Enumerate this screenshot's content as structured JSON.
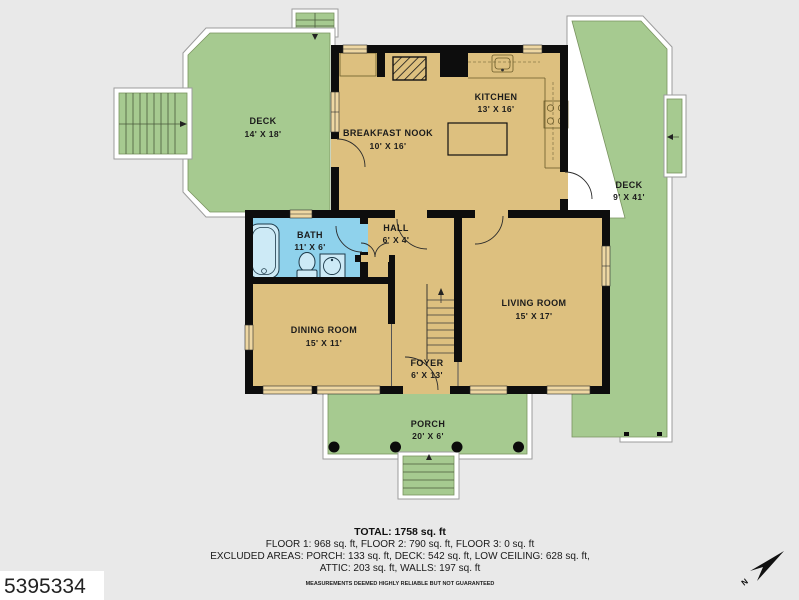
{
  "colors": {
    "background": "#e9e9e9",
    "floor": "#ddc07f",
    "deck": "#a6ca90",
    "bath": "#8fd2ec",
    "wall": "#0d0d0d",
    "window": "#eed7a3"
  },
  "rooms": [
    {
      "id": "deck-left",
      "name": "DECK",
      "dims": "14' X 18'"
    },
    {
      "id": "breakfast-nook",
      "name": "BREAKFAST NOOK",
      "dims": "10' X 16'"
    },
    {
      "id": "kitchen",
      "name": "KITCHEN",
      "dims": "13' X 16'"
    },
    {
      "id": "deck-right",
      "name": "DECK",
      "dims": "9' X 41'"
    },
    {
      "id": "bath",
      "name": "BATH",
      "dims": "11' X 6'"
    },
    {
      "id": "hall",
      "name": "HALL",
      "dims": "6' X 4'"
    },
    {
      "id": "dining-room",
      "name": "DINING ROOM",
      "dims": "15' X 11'"
    },
    {
      "id": "living-room",
      "name": "LIVING ROOM",
      "dims": "15' X 17'"
    },
    {
      "id": "foyer",
      "name": "FOYER",
      "dims": "6' X 13'"
    },
    {
      "id": "porch",
      "name": "PORCH",
      "dims": "20' X 6'"
    }
  ],
  "summary": {
    "total": "TOTAL: 1758 sq. ft",
    "floors": "FLOOR 1: 968 sq. ft, FLOOR 2: 790 sq. ft, FLOOR 3: 0 sq. ft",
    "excluded_line1": "EXCLUDED AREAS: PORCH: 133 sq. ft, DECK: 542 sq. ft, LOW CEILING: 628 sq. ft,",
    "excluded_line2": "ATTIC: 203 sq. ft, WALLS: 197 sq. ft",
    "disclaimer": "MEASUREMENTS DEEMED HIGHLY RELIABLE BUT NOT GUARANTEED"
  },
  "watermark": "5395334",
  "compass": {
    "label": "N"
  }
}
